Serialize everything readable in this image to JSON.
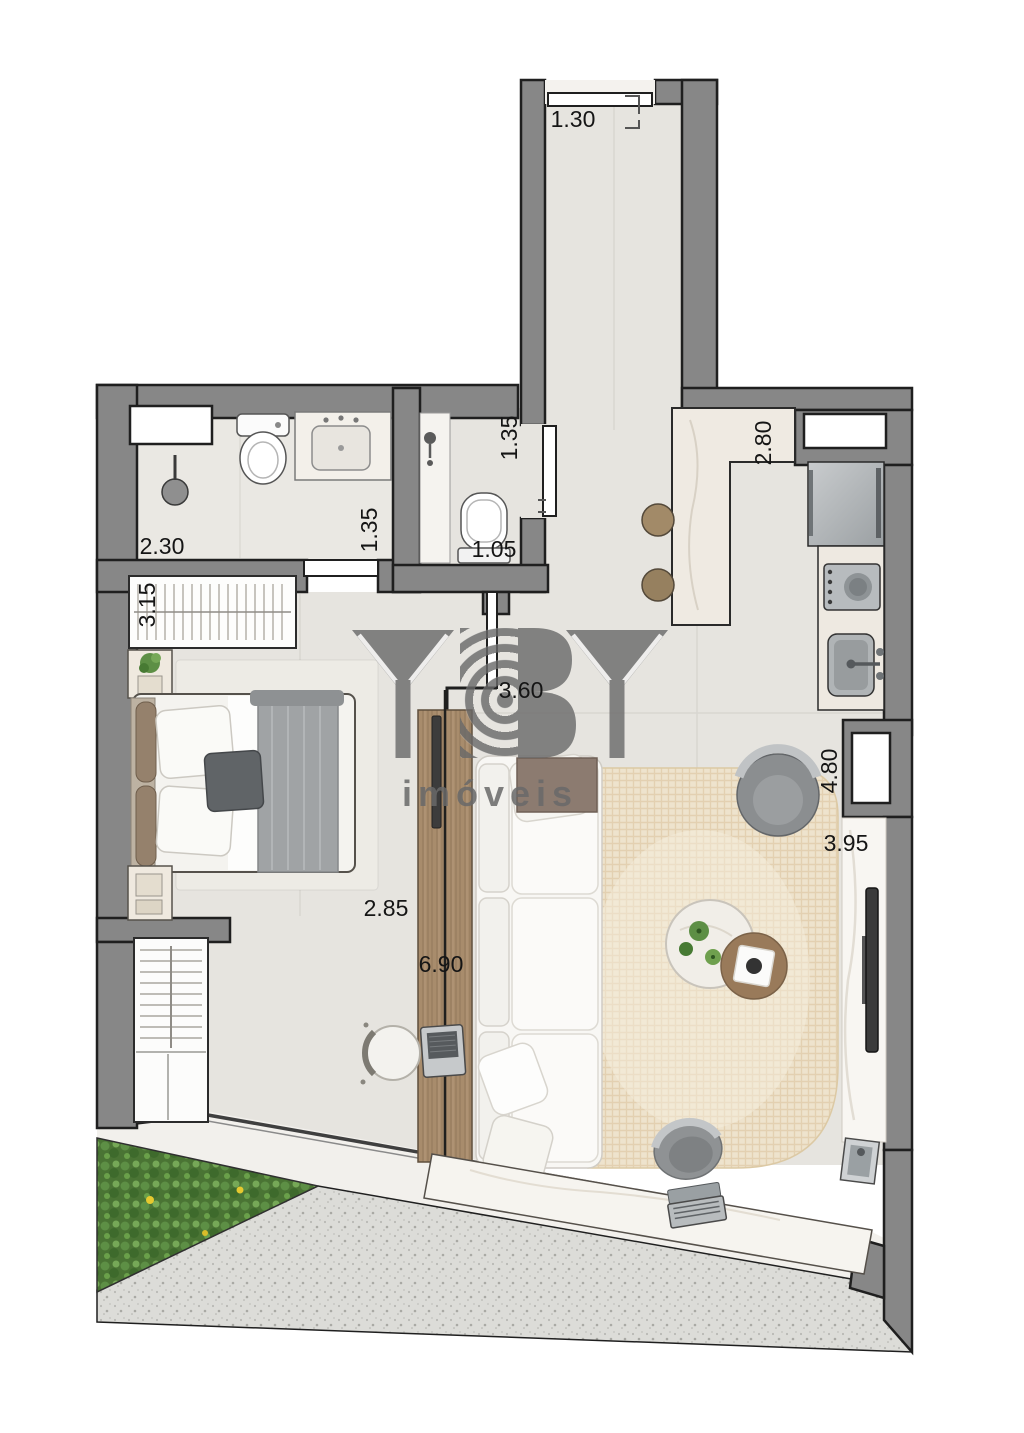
{
  "watermark": {
    "brand": "YBY",
    "tagline": "imóveis"
  },
  "dimensions": [
    {
      "id": "entry-hall-width",
      "text": "1.30"
    },
    {
      "id": "bath-1-width",
      "text": "2.30"
    },
    {
      "id": "bath-1-depth",
      "text": "1.35"
    },
    {
      "id": "bath-2-depth",
      "text": "1.35"
    },
    {
      "id": "bath-2-width",
      "text": "1.05"
    },
    {
      "id": "kitchen-depth",
      "text": "2.80"
    },
    {
      "id": "wardrobe-width",
      "text": "3.15"
    },
    {
      "id": "hall-length",
      "text": "3.60"
    },
    {
      "id": "bedroom-span",
      "text": "2.85"
    },
    {
      "id": "living-length",
      "text": "6.90"
    },
    {
      "id": "living-depth",
      "text": "4.80"
    },
    {
      "id": "balcony-span",
      "text": "3.95"
    }
  ],
  "colors": {
    "wall": "#878787",
    "outline": "#1f1f1f",
    "floor": "#e6e4df",
    "bathfloor": "#eae8e3",
    "balconyFloor": "#f2f0ec",
    "granite": "#dcdcd8",
    "garden": "#4a7434",
    "rug": "#eee3cd",
    "wood": "#a88c6c",
    "watermark": "#696969",
    "label": "#151515"
  }
}
